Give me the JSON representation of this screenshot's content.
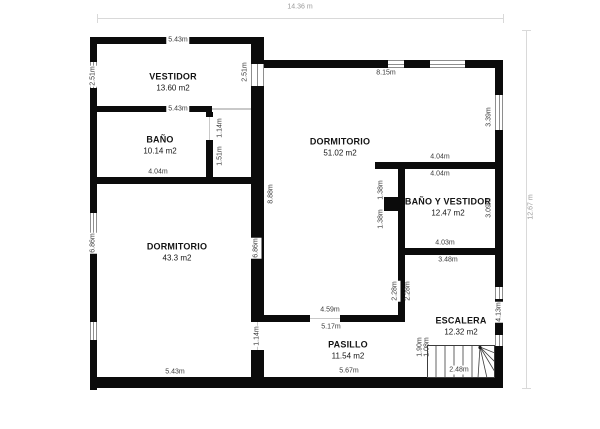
{
  "plan": {
    "overall_width": "14.36 m",
    "overall_height": "12.67 m"
  },
  "colors": {
    "wall": "#0b0b0b",
    "window": "#8e8e8e",
    "dimension_line": "#d9d9d9",
    "dimension_text": "#9a9a9a"
  },
  "rooms": [
    {
      "id": "vestidor",
      "name": "VESTIDOR",
      "area": "13.60 m2"
    },
    {
      "id": "bano",
      "name": "BAÑO",
      "area": "10.14 m2"
    },
    {
      "id": "dormitorio-grande",
      "name": "DORMITORIO",
      "area": "51.02 m2"
    },
    {
      "id": "bano-y-vestidor",
      "name": "BAÑO Y VESTIDOR",
      "area": "12.47 m2"
    },
    {
      "id": "dormitorio",
      "name": "DORMITORIO",
      "area": "43.3 m2"
    },
    {
      "id": "pasillo",
      "name": "PASILLO",
      "area": "11.54 m2"
    },
    {
      "id": "escalera",
      "name": "ESCALERA",
      "area": "12.32 m2"
    }
  ],
  "dims": {
    "vestidor_top": "5.43m",
    "vestidor_bottom": "5.43m",
    "vestidor_left": "2.51m",
    "vestidor_right": "2.51m",
    "bano_bottom": "4.04m",
    "bano_door": "1.14m",
    "bano_wall": "1.51m",
    "dorm51_top": "8.15m",
    "dorm51_right": "3.39m",
    "dorm51_left": "8.88m",
    "banovest_top_outer": "4.04m",
    "banovest_top_inner": "4.04m",
    "banovest_right": "3.09m",
    "banovest_box_top": "1.38m",
    "banovest_box_bottom": "1.38m",
    "banovest_bottom_inner": "4.03m",
    "banovest_bottom_outer": "3.48m",
    "dorm43_left": "6.86m",
    "dorm43_right": "6.86m",
    "dorm43_bottom": "5.43m",
    "divider_left": "2.28m",
    "divider_right": "2.28m",
    "pasillo_top_outer": "4.59m",
    "pasillo_top_inner": "5.17m",
    "pasillo_bottom": "5.67m",
    "pasillo_door": "1.14m",
    "escalera_right": "4.13m",
    "stairs_left_a": "1.90m",
    "stairs_left_b": "1.08m",
    "stairs_bottom": "2.48m"
  }
}
